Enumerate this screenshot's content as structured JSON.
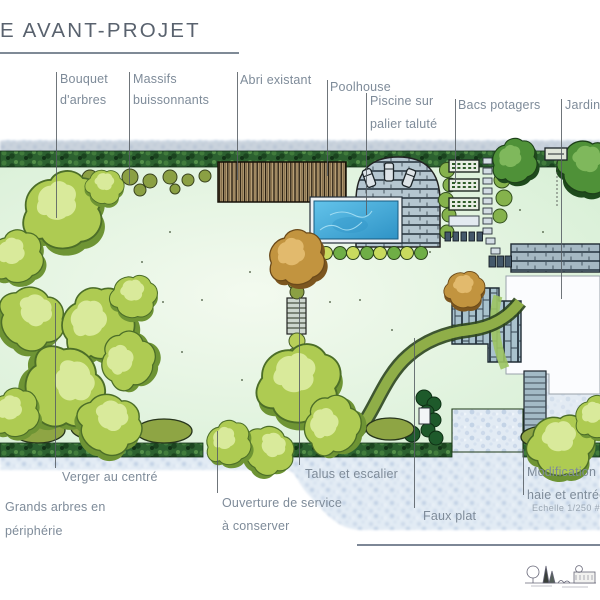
{
  "header": {
    "title": "E AVANT-PROJET"
  },
  "annotations": {
    "bouquet": "Bouquet d'arbres",
    "massifs": "Massifs buissonnants",
    "abri": "Abri existant",
    "poolhouse": "Poolhouse",
    "piscine": "Piscine sur palier taluté",
    "bacs": "Bacs potagers",
    "jardin": "Jardin",
    "verger": "Verger au centré",
    "grands_arbres": "Grands arbres en périphérie",
    "ouverture": "Ouverture de service à conserver",
    "talus": "Talus et escalier",
    "faux_plat": "Faux plat",
    "modification_line1": "Modification",
    "modification_line2": "haie et entrée",
    "echelle": "Echelle 1/250 #"
  },
  "plan": {
    "type": "garden-masterplan-watercolor",
    "features": [
      "lawn",
      "perimeter-hedge",
      "tree-clusters",
      "orchard",
      "existing-shed",
      "poolhouse",
      "pool",
      "stone-pool-terrace",
      "sun-loungers",
      "shrub-row",
      "vegetable-beds",
      "stepping-stones",
      "stone-wall",
      "house-terrace",
      "stone-patio",
      "stairs-on-slope",
      "service-opening",
      "entrance-driveway",
      "scale-sketch-logo"
    ],
    "colors": {
      "outside_blue": "#e2ebf4",
      "lawn": "#e2f3dc",
      "hedge_dark": "#2c6130",
      "tree_light": "#aecb52",
      "tree_dark": "#4f9138",
      "tree_autumn": "#c2943f",
      "pool_water": "#3fa5d8",
      "stone": "#b5c6d0",
      "label_gray": "#7e8b99",
      "title_gray": "#59626e"
    }
  }
}
